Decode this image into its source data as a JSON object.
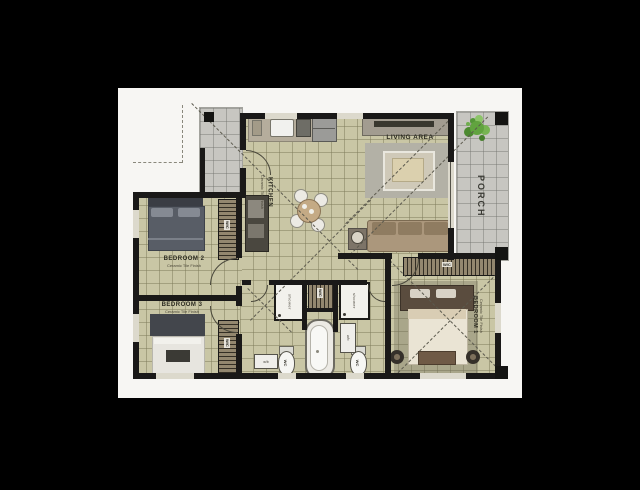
{
  "meta": {
    "type": "architectural-floor-plan",
    "background_color": "#000000",
    "canvas_color": "#f7f6f3",
    "wall_color": "#1a1918",
    "floor_tile_color": "#c9c6a5",
    "porch_tile_color": "#c7c6c1",
    "plant_color": "#6aa648"
  },
  "rooms": {
    "kitchen": {
      "label": "KITCHEN",
      "sublabel": "Ceramic Tile Finish"
    },
    "living_area": {
      "label": "LIVING AREA"
    },
    "porch": {
      "label": "PORCH"
    },
    "bedroom1": {
      "label": "BEDROOM 1",
      "sublabel": "Ceramic Tile Finish"
    },
    "bedroom2": {
      "label": "BEDROOM 2",
      "sublabel": "Ceramic Tile Finish"
    },
    "bedroom3": {
      "label": "BEDROOM 3",
      "sublabel": "Ceramic Tile Finish"
    }
  },
  "fixtures": {
    "shower": "shower",
    "wc": "WC",
    "washbasin": "w/b",
    "wardrobe": "W/C"
  }
}
